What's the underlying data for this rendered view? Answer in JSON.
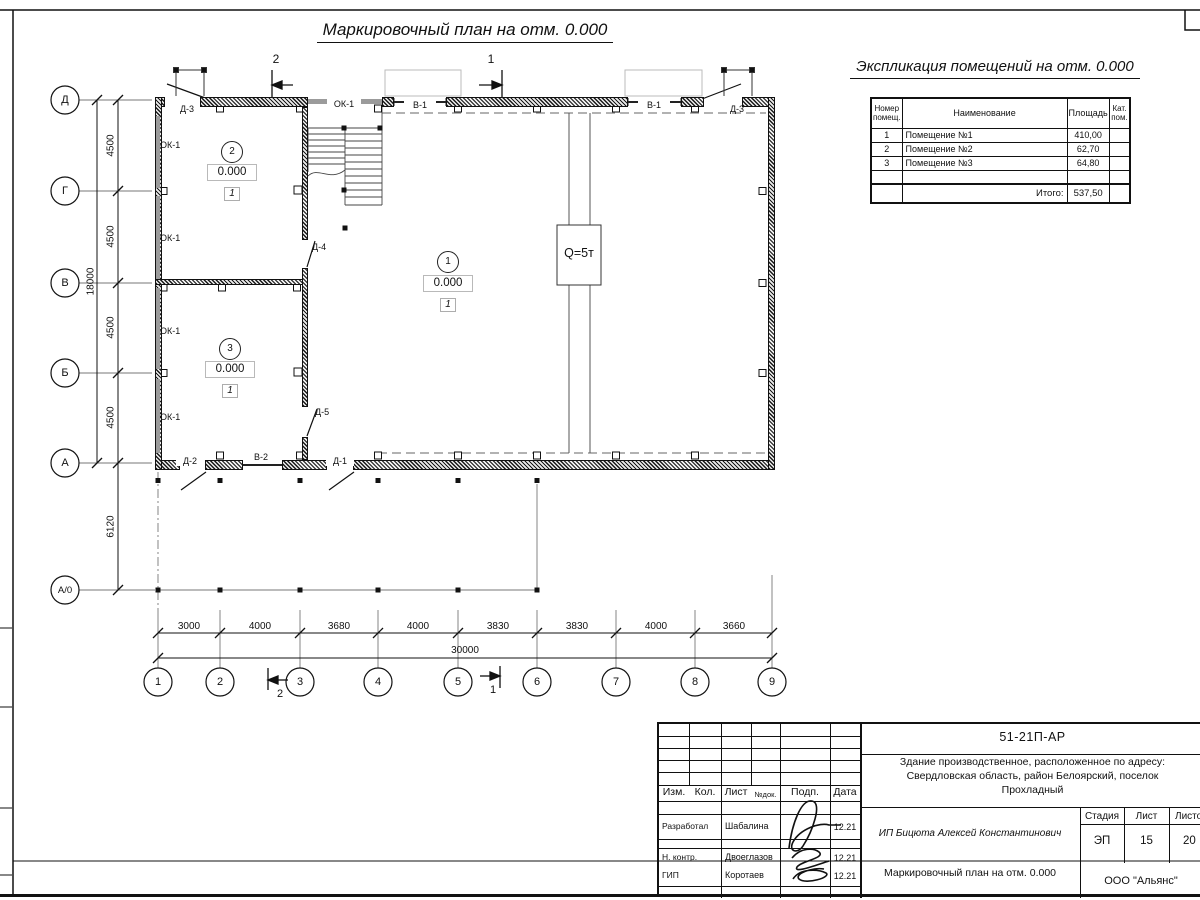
{
  "title": "Маркировочный план на отм. 0.000",
  "explication": {
    "title": "Экспликация помещений на отм. 0.000",
    "col_num": "Номер помещ.",
    "col_name": "Наименование",
    "col_area": "Площадь",
    "col_cat": "Кат. пом.",
    "rows": [
      {
        "num": "1",
        "name": "Помещение №1",
        "area": "410,00"
      },
      {
        "num": "2",
        "name": "Помещение №2",
        "area": "62,70"
      },
      {
        "num": "3",
        "name": "Помещение №3",
        "area": "64,80"
      }
    ],
    "total_label": "Итого:",
    "total_area": "537,50"
  },
  "plan": {
    "axes_v": [
      "Д",
      "Г",
      "В",
      "Б",
      "А",
      "А/0"
    ],
    "axes_h": [
      "1",
      "2",
      "3",
      "4",
      "5",
      "6",
      "7",
      "8",
      "9"
    ],
    "dims_v": [
      "4500",
      "4500",
      "4500",
      "4500"
    ],
    "dim_v_total": "18000",
    "dim_v_below": "6120",
    "dims_h": [
      "3000",
      "4000",
      "3680",
      "4000",
      "3830",
      "3830",
      "4000",
      "3660"
    ],
    "dim_h_total": "30000",
    "labels": {
      "ok1": "ОК-1",
      "v1": "В-1",
      "v2": "В-2",
      "d1": "Д-1",
      "d2": "Д-2",
      "d3": "Д-3",
      "d4": "Д-4",
      "d5": "Д-5"
    },
    "crane": "Q=5т",
    "rooms": [
      {
        "num": "1",
        "elev": "0.000",
        "mark": "1"
      },
      {
        "num": "2",
        "elev": "0.000",
        "mark": "1"
      },
      {
        "num": "3",
        "elev": "0.000",
        "mark": "1"
      }
    ],
    "section1": "1",
    "section2": "2"
  },
  "titleblock": {
    "doc_code": "51-21П-АР",
    "address_lines": [
      "Здание производственное, расположенное по адресу:",
      "Свердловская область, район Белоярский, поселок",
      "Прохладный"
    ],
    "cols": {
      "izm": "Изм.",
      "kol": "Кол.",
      "list": "Лист",
      "ndok": "№док.",
      "podp": "Подп.",
      "data": "Дата"
    },
    "roles": [
      {
        "role": "Разработал",
        "name": "Шабалина",
        "date": "12.21"
      },
      {
        "role": "Н. контр.",
        "name": "Двоеглазов",
        "date": "12.21"
      },
      {
        "role": "ГИП",
        "name": "Коротаев",
        "date": "12.21"
      }
    ],
    "client": "ИП Бицюта Алексей Константинович",
    "stage_label": "Стадия",
    "sheet_label": "Лист",
    "sheets_label": "Листов",
    "stage": "ЭП",
    "sheet": "15",
    "sheets": "20",
    "sheet_title": "Маркировочный план на отм. 0.000",
    "company": "ООО \"Альянс\""
  }
}
